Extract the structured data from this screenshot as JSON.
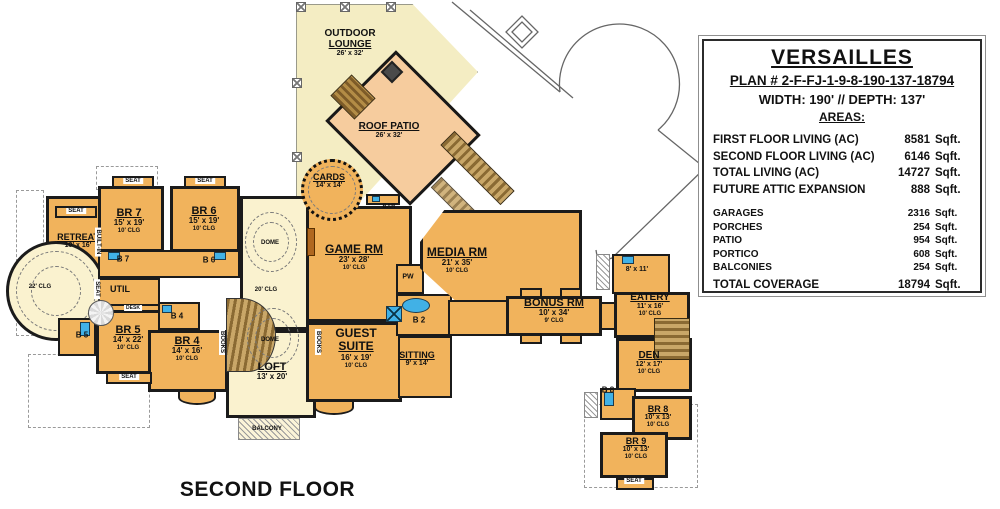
{
  "floor_label": "SECOND FLOOR",
  "colors": {
    "room_fill": "#F1B35C",
    "hall_fill": "#FAF2CF",
    "lounge_fill": "#F4EDC3",
    "patio_fill": "#F6CC9E",
    "wall": "#1b1b1b",
    "fixture_blue": "#41B1E6",
    "stair_brown": "#8A6A33"
  },
  "info_box": {
    "title": "VERSAILLES",
    "plan_number": "PLAN # 2-F-FJ-1-9-8-190-137-18794",
    "width_depth": "WIDTH: 190'  // DEPTH: 137'",
    "areas_heading": "AREAS:",
    "area_rows": [
      {
        "label": "FIRST FLOOR LIVING (AC)",
        "value": "8581",
        "unit": "Sqft.",
        "group": "primary"
      },
      {
        "label": "SECOND FLOOR LIVING (AC)",
        "value": "6146",
        "unit": "Sqft.",
        "group": "primary"
      },
      {
        "label": "TOTAL LIVING (AC)",
        "value": "14727",
        "unit": "Sqft.",
        "group": "primary"
      },
      {
        "label": "FUTURE ATTIC EXPANSION",
        "value": "888",
        "unit": "Sqft.",
        "group": "primary"
      },
      {
        "label": "GARAGES",
        "value": "2316",
        "unit": "Sqft.",
        "group": "secondary"
      },
      {
        "label": "PORCHES",
        "value": "254",
        "unit": "Sqft.",
        "group": "secondary"
      },
      {
        "label": "PATIO",
        "value": "954",
        "unit": "Sqft.",
        "group": "secondary"
      },
      {
        "label": "PORTICO",
        "value": "608",
        "unit": "Sqft.",
        "group": "secondary"
      },
      {
        "label": "BALCONIES",
        "value": "254",
        "unit": "Sqft.",
        "group": "secondary"
      },
      {
        "label": "TOTAL COVERAGE",
        "value": "18794",
        "unit": "Sqft.",
        "group": "total"
      }
    ]
  },
  "plan": {
    "room_labels": [
      {
        "id": "outdoor-lounge",
        "name": "OUTDOOR",
        "name2": "LOUNGE",
        "dims": "26' x 32'",
        "cx": 350,
        "y": 28,
        "nfs": 10
      },
      {
        "id": "roof-patio",
        "name": "ROOF PATIO",
        "dims": "26' x 32'",
        "cx": 389,
        "y": 121,
        "nfs": 10
      },
      {
        "id": "cards",
        "name": "CARDS",
        "dims": "14' x 14'",
        "cx": 329,
        "y": 172,
        "nfs": 9
      },
      {
        "id": "game-rm",
        "name": "GAME RM",
        "dims": "23' x 28'",
        "clg": "10' CLG",
        "cx": 354,
        "y": 243,
        "nfs": 12
      },
      {
        "id": "media-rm",
        "name": "MEDIA RM",
        "dims": "21' x 35'",
        "clg": "10' CLG",
        "cx": 457,
        "y": 246,
        "nfs": 12
      },
      {
        "id": "guest-suite",
        "name": "GUEST",
        "name2": "SUITE",
        "dims": "16' x 19'",
        "clg": "10' CLG",
        "cx": 356,
        "y": 327,
        "nfs": 12
      },
      {
        "id": "sitting",
        "name": "SITTING",
        "dims": "9' x 14'",
        "cx": 417,
        "y": 350,
        "nfs": 9
      },
      {
        "id": "bonus-rm",
        "name": "BONUS RM",
        "dims": "10' x 34'",
        "clg": "9' CLG",
        "cx": 554,
        "y": 297,
        "nfs": 11
      },
      {
        "id": "eatery",
        "name": "EATERY",
        "dims": "11' x 16'",
        "clg": "10' CLG",
        "cx": 650,
        "y": 292,
        "nfs": 10
      },
      {
        "id": "kitchenette",
        "dims": "8' x 11'",
        "cx": 637,
        "y": 266,
        "nfs": 9
      },
      {
        "id": "den",
        "name": "DEN",
        "dims": "12' x 17'",
        "clg": "10' CLG",
        "cx": 649,
        "y": 350,
        "nfs": 10
      },
      {
        "id": "br-8",
        "name": "BR 8",
        "dims": "10' x 13'",
        "clg": "10' CLG",
        "cx": 658,
        "y": 404,
        "nfs": 9
      },
      {
        "id": "br-9",
        "name": "BR 9",
        "dims": "10' x 13'",
        "clg": "10' CLG",
        "cx": 636,
        "y": 436,
        "nfs": 9
      },
      {
        "id": "retreat",
        "name": "RETREAT",
        "dims": "10' x 16'",
        "cx": 78,
        "y": 232,
        "nfs": 9
      },
      {
        "id": "br-7",
        "name": "BR 7",
        "dims": "15' x 19'",
        "clg": "10' CLG",
        "cx": 129,
        "y": 207,
        "nfs": 11
      },
      {
        "id": "br-6",
        "name": "BR 6",
        "dims": "15' x 19'",
        "clg": "10' CLG",
        "cx": 204,
        "y": 205,
        "nfs": 11
      },
      {
        "id": "br-5",
        "name": "BR 5",
        "dims": "14' x 22'",
        "clg": "10' CLG",
        "cx": 128,
        "y": 324,
        "nfs": 11
      },
      {
        "id": "br-4",
        "name": "BR 4",
        "dims": "14' x 16'",
        "clg": "10' CLG",
        "cx": 187,
        "y": 335,
        "nfs": 11
      },
      {
        "id": "loft",
        "name": "LOFT",
        "dims": "13' x 20'",
        "cx": 272,
        "y": 361,
        "nfs": 11
      }
    ],
    "small_labels": [
      {
        "id": "bar",
        "text": "BAR",
        "x": 389,
        "y": 207,
        "fs": 6
      },
      {
        "id": "pw",
        "text": "PW",
        "x": 408,
        "y": 277,
        "fs": 7
      },
      {
        "id": "b-2",
        "text": "B 2",
        "x": 419,
        "y": 320,
        "fs": 8
      },
      {
        "id": "b-7",
        "text": "B 7",
        "x": 123,
        "y": 259,
        "fs": 8
      },
      {
        "id": "b-6",
        "text": "B 6",
        "x": 209,
        "y": 260,
        "fs": 8
      },
      {
        "id": "b-5",
        "text": "B 5",
        "x": 82,
        "y": 335,
        "fs": 8
      },
      {
        "id": "b-4",
        "text": "B 4",
        "x": 177,
        "y": 316,
        "fs": 8
      },
      {
        "id": "b-8",
        "text": "B 8",
        "x": 608,
        "y": 390,
        "fs": 8
      },
      {
        "id": "util",
        "text": "UTIL",
        "x": 120,
        "y": 289,
        "fs": 9
      },
      {
        "id": "desk",
        "text": "DESK",
        "x": 133,
        "y": 308,
        "fs": 5,
        "box": true
      },
      {
        "id": "dome-upper",
        "text": "DOME",
        "x": 270,
        "y": 243,
        "fs": 6
      },
      {
        "id": "gallery-clg",
        "text": "20' CLG",
        "x": 266,
        "y": 290,
        "fs": 6
      },
      {
        "id": "dome-lower",
        "text": "DOME",
        "x": 270,
        "y": 340,
        "fs": 6
      },
      {
        "id": "tower-clg",
        "text": "22' CLG",
        "x": 40,
        "y": 287,
        "fs": 6
      },
      {
        "id": "balcony",
        "text": "BALCONY",
        "x": 267,
        "y": 429,
        "fs": 6
      },
      {
        "id": "seat-retreat",
        "text": "SEAT",
        "x": 76,
        "y": 211,
        "fs": 6,
        "box": true
      },
      {
        "id": "seat-br7",
        "text": "SEAT",
        "x": 133,
        "y": 181,
        "fs": 6,
        "box": true
      },
      {
        "id": "seat-br6",
        "text": "SEAT",
        "x": 205,
        "y": 181,
        "fs": 6,
        "box": true
      },
      {
        "id": "seat-br5",
        "text": "SEAT",
        "x": 129,
        "y": 377,
        "fs": 6,
        "box": true
      },
      {
        "id": "seat-br9",
        "text": "SEAT",
        "x": 634,
        "y": 481,
        "fs": 6,
        "box": true
      },
      {
        "id": "seat-gallery",
        "text": "SEAT",
        "x": 97,
        "y": 289,
        "fs": 6,
        "box": true,
        "rot": true
      },
      {
        "id": "built-in",
        "text": "BUILT-IN",
        "x": 98,
        "y": 242,
        "fs": 6,
        "box": true,
        "rot": true
      },
      {
        "id": "books-left",
        "text": "BOOKS",
        "x": 222,
        "y": 342,
        "fs": 6,
        "box": true,
        "rot": true
      },
      {
        "id": "books-right",
        "text": "BOOKS",
        "x": 318,
        "y": 342,
        "fs": 6,
        "box": true,
        "rot": true
      }
    ]
  }
}
